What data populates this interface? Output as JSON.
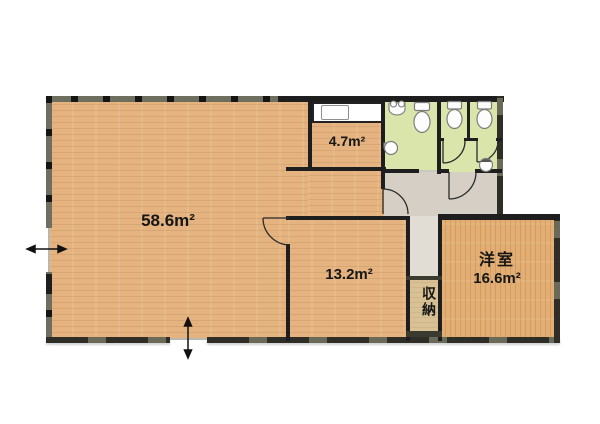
{
  "type": "japanese-apartment-floor-plan",
  "rooms": {
    "living": {
      "area": "58.6m²"
    },
    "kitchen": {
      "area": "4.7m²"
    },
    "middle_room": {
      "area": "13.2m²"
    },
    "western_room": {
      "name": "洋室",
      "area": "16.6m²"
    },
    "closet": {
      "name": "収納"
    }
  },
  "icons": [
    "toilet-icon",
    "urinal-icon",
    "round-sink-icon",
    "kitchen-sink-icon",
    "door-swing-icon",
    "entry-arrow-horizontal-icon",
    "entry-arrow-vertical-icon"
  ],
  "colors": {
    "wood_floor": "#e4b37f",
    "western_floor": "#e2ae74",
    "wet_area": "#d9e5ab",
    "hallway": "#d6cfc5",
    "nook": "#e1dcd4",
    "closet_floor": "#d9c196",
    "outer_wall": "#6f6f5f",
    "inner_wall": "#1e1e1e",
    "fixture_stroke": "#8a8a8a"
  }
}
